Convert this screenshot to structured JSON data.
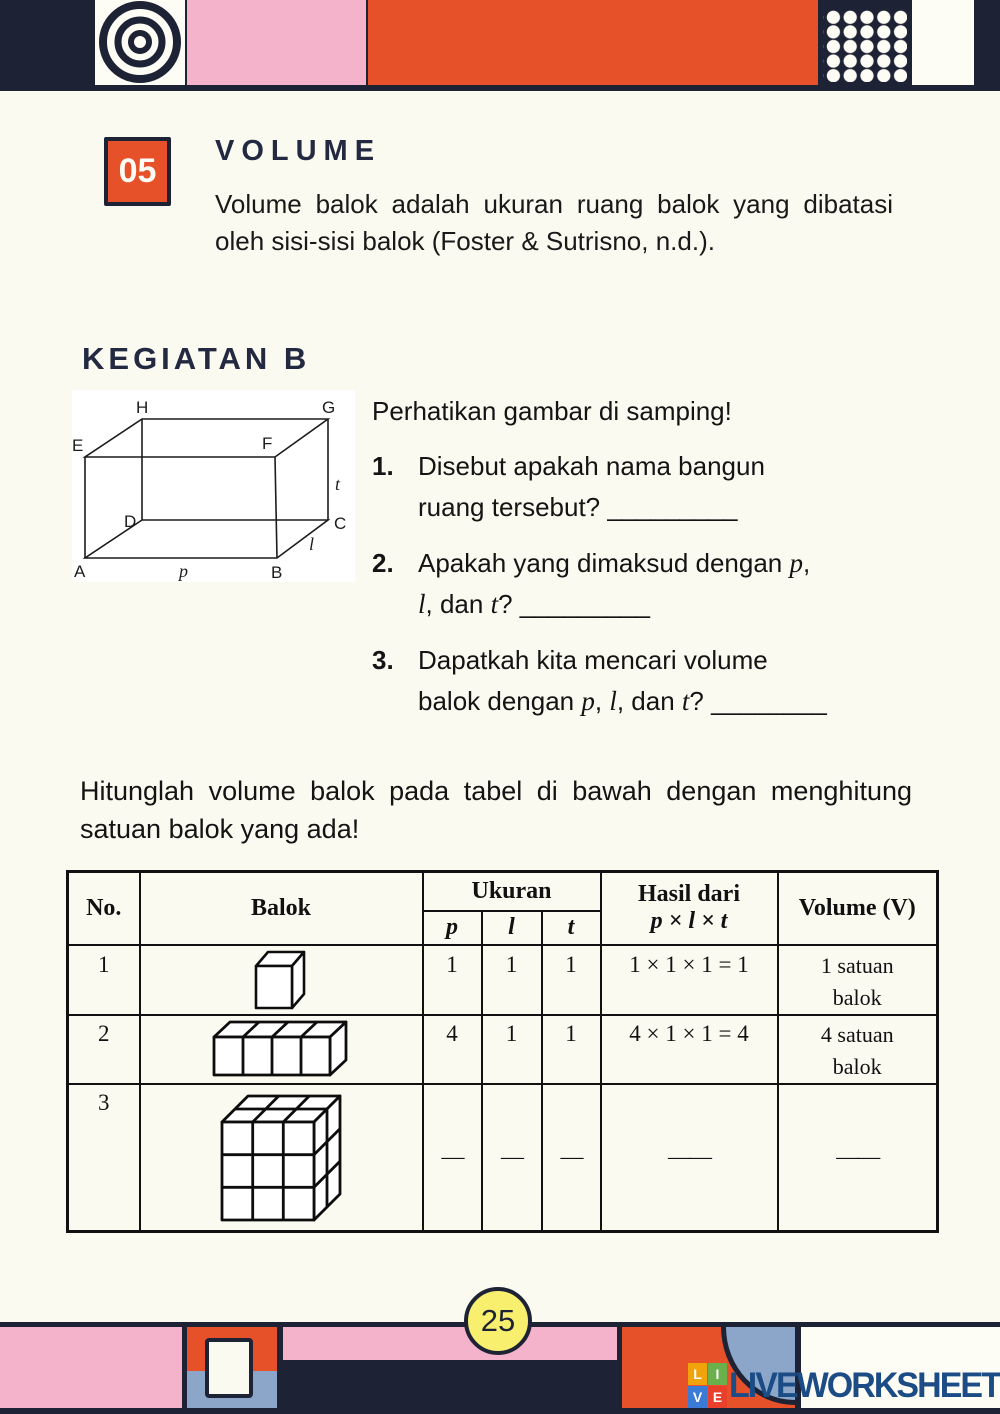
{
  "lesson": {
    "number": "05",
    "title": "VOLUME",
    "intro": "Volume balok adalah ukuran ruang balok yang dibatasi oleh sisi-sisi balok (Foster & Sutrisno, n.d.)."
  },
  "activity": {
    "title": "KEGIATAN B",
    "figure": {
      "labels": {
        "A": "A",
        "B": "B",
        "C": "C",
        "D": "D",
        "E": "E",
        "F": "F",
        "G": "G",
        "H": "H",
        "p": "p",
        "l": "l",
        "t": "t"
      }
    },
    "prompt": "Perhatikan gambar di samping!",
    "questions": [
      {
        "num": "1.",
        "line1": "Disebut apakah nama bangun",
        "line2": "ruang tersebut? _________"
      },
      {
        "num": "2.",
        "l1a": "Apakah yang dimaksud dengan ",
        "l1b": "p",
        "l1c": ",",
        "l2a": "l",
        "l2b": ", dan ",
        "l2c": "t",
        "l2d": "? _________"
      },
      {
        "num": "3.",
        "l1": "Dapatkah kita mencari volume",
        "l2a": "balok dengan ",
        "l2b": "p",
        "l2c": ", ",
        "l2d": "l",
        "l2e": ", dan ",
        "l2f": "t",
        "l2g": "? ________"
      }
    ]
  },
  "exercise": {
    "instruction": "Hitunglah volume balok pada tabel di bawah dengan menghitung satuan balok yang ada!",
    "table": {
      "headers": {
        "no": "No.",
        "balok": "Balok",
        "ukuran": "Ukuran",
        "p": "p",
        "l": "l",
        "t": "t",
        "hasil_line1": "Hasil dari",
        "hasil_line2": "p × l × t",
        "volume": "Volume (V)"
      },
      "rows": [
        {
          "no": "1",
          "figure": "unit-cube",
          "p": "1",
          "l": "1",
          "t": "1",
          "hasil": "1 × 1 × 1 = 1",
          "vol1": "1 satuan",
          "vol2": "balok"
        },
        {
          "no": "2",
          "figure": "four-cube-row",
          "p": "4",
          "l": "1",
          "t": "1",
          "hasil": "4 × 1 × 1 = 4",
          "vol1": "4 satuan",
          "vol2": "balok"
        },
        {
          "no": "3",
          "figure": "stacked-cube-block",
          "p": "—",
          "l": "—",
          "t": "—",
          "hasil": "——",
          "vol1": "——",
          "vol2": ""
        }
      ]
    }
  },
  "footer": {
    "page_number": "25",
    "logo_squares": [
      "L",
      "I",
      "V",
      "E"
    ],
    "logo_text": "LIVEWORKSHEETS"
  },
  "colors": {
    "navy": "#1d2235",
    "orange": "#e7512a",
    "pink": "#f4b3cb",
    "cream": "#fbfaf1",
    "yellow": "#f7ef6d",
    "steel_blue": "#8ba6c9",
    "logo_blue": "#1b4c86",
    "logo_l": "#f0a30a",
    "logo_i": "#6ab04c",
    "logo_v": "#3a7bd5",
    "logo_e": "#e8402a"
  }
}
